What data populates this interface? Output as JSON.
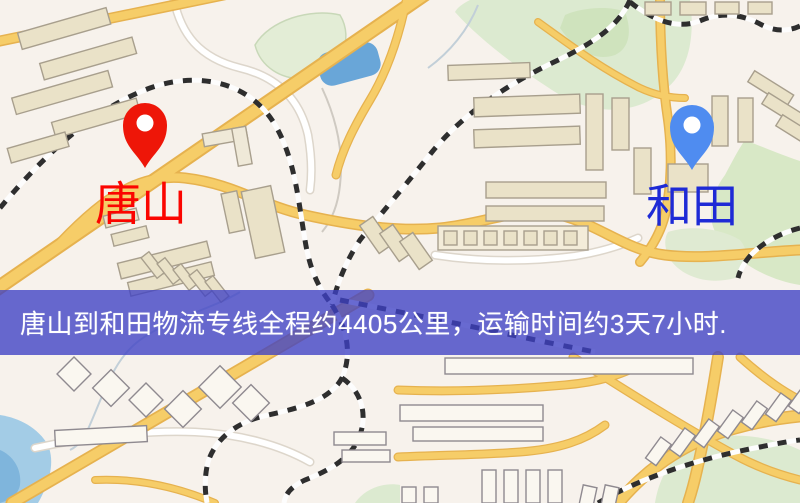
{
  "banner": {
    "text": "唐山到和田物流专线全程约4405公里，运输时间约3天7小时.",
    "bg_color": "#3e40c4",
    "text_color": "#ffffff"
  },
  "origin": {
    "label": "唐山",
    "label_color": "#fb0500",
    "pin_color": "#ee1608",
    "pin_icon": "map-pin"
  },
  "destination": {
    "label": "和田",
    "label_color": "#1e2ad6",
    "pin_color": "#4f8cf0",
    "pin_icon": "map-pin"
  },
  "map": {
    "palette": {
      "background": "#f7f2ec",
      "road_major_fill": "#f6cd68",
      "road_major_casing": "#e6b24f",
      "road_minor_fill": "#f8d77e",
      "building": "#eae2c8",
      "building_outline": "#a89f8d",
      "park": "#dcead0",
      "water": "#7fb5dc",
      "pond": "#69a6d8",
      "railway_dark": "#2e2e2e",
      "railway_light": "#fdfdfd"
    }
  }
}
